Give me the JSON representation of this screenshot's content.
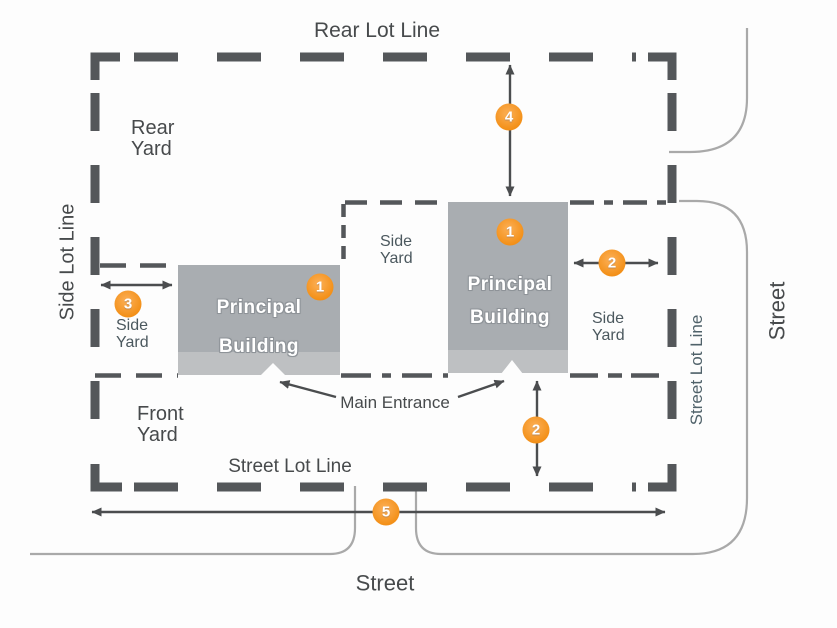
{
  "diagram": {
    "labels": {
      "rear_lot_line": "Rear Lot Line",
      "side_lot_line_left": "Side Lot Line",
      "street_lot_line_bottom": "Street Lot Line",
      "street_lot_line_right": "Street Lot Line",
      "street_bottom": "Street",
      "street_right": "Street",
      "main_entrance": "Main Entrance",
      "rear_yard": {
        "line1": "Rear",
        "line2": "Yard"
      },
      "front_yard": {
        "line1": "Front",
        "line2": "Yard"
      },
      "side_yard_left": {
        "line1": "Side",
        "line2": "Yard"
      },
      "side_yard_middle": {
        "line1": "Side",
        "line2": "Yard"
      },
      "side_yard_right": {
        "line1": "Side",
        "line2": "Yard"
      }
    },
    "buildings": {
      "left": {
        "line1": "Principal",
        "line2": "Building"
      },
      "right": {
        "line1": "Principal",
        "line2": "Building"
      }
    },
    "markers": {
      "building_left": "1",
      "building_right": "1",
      "side_setback_right": "2",
      "front_setback_right": "2",
      "side_setback_left": "3",
      "rear_setback": "4",
      "street_frontage": "5"
    },
    "colors": {
      "accent_orange": "#f7941e",
      "building_gray": "#a9adb1",
      "building_base_gray": "#bec0c2",
      "lot_line_gray": "#54575a",
      "arrow_gray": "#4b4d4f",
      "curb_light_gray": "#a9a9a9",
      "label_gray": "#474a4c"
    }
  }
}
